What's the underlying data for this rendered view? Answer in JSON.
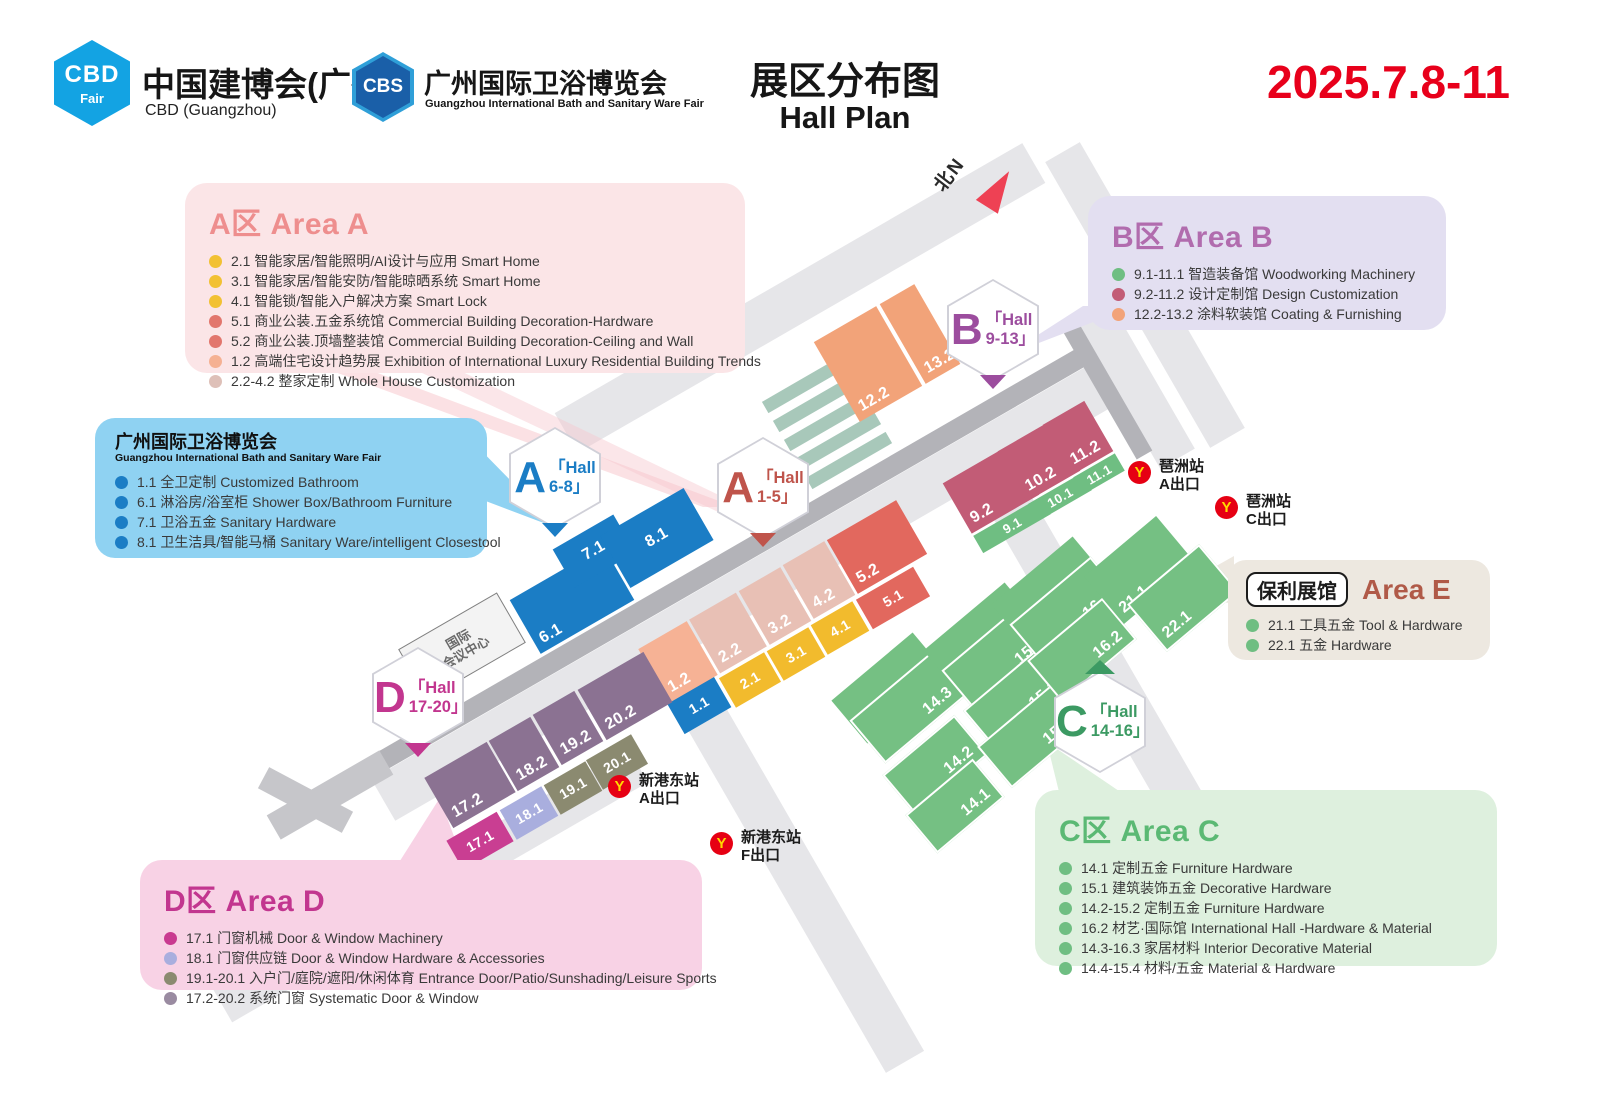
{
  "header": {
    "logo_cbd": {
      "icon": "CBD",
      "icon_sub": "Fair",
      "title": "中国建博会(广州)",
      "subtitle": "CBD (Guangzhou)"
    },
    "logo_cbs": {
      "icon": "CBS",
      "title": "广州国际卫浴博览会",
      "subtitle": "Guangzhou International Bath and Sanitary Ware Fair"
    },
    "title_cn": "展区分布图",
    "title_en": "Hall Plan",
    "date": "2025.7.8-11",
    "date_color": "#e8001b"
  },
  "north_label": "北N",
  "legends": {
    "area_a": {
      "title": "A区 Area A",
      "accent": "#ee8e8e",
      "bg": "#fbe5e7",
      "items": [
        {
          "dot": "#f2c133",
          "text": "2.1 智能家居/智能照明/AI设计与应用 Smart Home"
        },
        {
          "dot": "#f2c133",
          "text": "3.1 智能家居/智能安防/智能晾晒系统 Smart Home"
        },
        {
          "dot": "#f2c133",
          "text": "4.1 智能锁/智能入户解决方案 Smart Lock"
        },
        {
          "dot": "#e2766d",
          "text": "5.1 商业公装.五金系统馆 Commercial Building Decoration-Hardware"
        },
        {
          "dot": "#e2766d",
          "text": "5.2 商业公装.顶墙整装馆 Commercial Building Decoration-Ceiling and Wall"
        },
        {
          "dot": "#f5b193",
          "text": "1.2 高端住宅设计趋势展 Exhibition of International Luxury Residential Building Trends"
        },
        {
          "dot": "#dec0b8",
          "text": "2.2-4.2 整家定制 Whole House Customization"
        }
      ]
    },
    "bath": {
      "title_cn": "广州国际卫浴博览会",
      "title_en": "Guangzhou International Bath and Sanitary Ware Fair",
      "bg": "#8fd2f2",
      "items": [
        {
          "dot": "#1b7dc5",
          "text": "1.1 全卫定制 Customized Bathroom"
        },
        {
          "dot": "#1b7dc5",
          "text": "6.1 淋浴房/浴室柜 Shower Box/Bathroom Furniture"
        },
        {
          "dot": "#1b7dc5",
          "text": "7.1 卫浴五金 Sanitary Hardware"
        },
        {
          "dot": "#1b7dc5",
          "text": "8.1 卫生洁具/智能马桶 Sanitary Ware/intelligent Closestool"
        }
      ]
    },
    "area_b": {
      "title": "B区 Area B",
      "accent": "#b16cae",
      "bg": "#e3dff1",
      "items": [
        {
          "dot": "#6fbe82",
          "text": "9.1-11.1 智造装备馆 Woodworking Machinery"
        },
        {
          "dot": "#c25c76",
          "text": "9.2-11.2 设计定制馆 Design Customization"
        },
        {
          "dot": "#f2a379",
          "text": "12.2-13.2 涂料软装馆 Coating & Furnishing"
        }
      ]
    },
    "area_e": {
      "venue": "保利展馆",
      "title": "Area E",
      "accent": "#b05a48",
      "bg": "#ede8e0",
      "items": [
        {
          "dot": "#6fbe82",
          "text": "21.1 工具五金 Tool & Hardware"
        },
        {
          "dot": "#6fbe82",
          "text": "22.1 五金 Hardware"
        }
      ]
    },
    "area_c": {
      "title": "C区 Area C",
      "accent": "#5bb974",
      "bg": "#def0de",
      "items": [
        {
          "dot": "#6fbe82",
          "text": "14.1 定制五金 Furniture Hardware"
        },
        {
          "dot": "#6fbe82",
          "text": "15.1 建筑装饰五金 Decorative Hardware"
        },
        {
          "dot": "#6fbe82",
          "text": "14.2-15.2 定制五金 Furniture Hardware"
        },
        {
          "dot": "#6fbe82",
          "text": "16.2 材艺·国际馆 International Hall -Hardware & Material"
        },
        {
          "dot": "#6fbe82",
          "text": "14.3-16.3 家居材料 Interior Decorative Material"
        },
        {
          "dot": "#6fbe82",
          "text": "14.4-15.4 材料/五金 Material & Hardware"
        }
      ]
    },
    "area_d": {
      "title": "D区 Area D",
      "accent": "#c2368f",
      "bg": "#f8d2e5",
      "items": [
        {
          "dot": "#c93a90",
          "text": "17.1 门窗机械 Door & Window Machinery"
        },
        {
          "dot": "#a9aede",
          "text": "18.1 门窗供应链 Door & Window Hardware & Accessories"
        },
        {
          "dot": "#8b8a70",
          "text": "19.1-20.1 入户门/庭院/遮阳/休闲体育 Entrance Door/Patio/Sunshading/Leisure Sports"
        },
        {
          "dot": "#9a8ba1",
          "text": "17.2-20.2 系统门窗 Systematic Door & Window"
        }
      ]
    }
  },
  "map": {
    "convention_center": {
      "line1": "国际",
      "line2": "会议中心"
    },
    "metro_colors": {
      "circle": "#e60013",
      "glyph": "#ffd800"
    },
    "badges": [
      {
        "id": "a-6-8",
        "letter": "A",
        "hall": "「Hall",
        "range": "6-8」",
        "color": "#1b7dc5",
        "x": 555,
        "y": 478,
        "ptr": "down"
      },
      {
        "id": "a-1-5",
        "letter": "A",
        "hall": "「Hall",
        "range": "1-5」",
        "color": "#bf544b",
        "x": 763,
        "y": 488,
        "ptr": "down"
      },
      {
        "id": "b-9-13",
        "letter": "B",
        "hall": "「Hall",
        "range": "9-13」",
        "color": "#9c4d9e",
        "x": 993,
        "y": 330,
        "ptr": "down"
      },
      {
        "id": "c-14-16",
        "letter": "C",
        "hall": "「Hall",
        "range": "14-16」",
        "color": "#3c9a63",
        "x": 1100,
        "y": 722,
        "ptr": "up"
      },
      {
        "id": "d-17-20",
        "letter": "D",
        "hall": "「Hall",
        "range": "17-20」",
        "color": "#c2368f",
        "x": 418,
        "y": 698,
        "ptr": "down"
      }
    ],
    "stations": [
      {
        "name": "琶洲站",
        "exit": "A出口",
        "x": 1140,
        "y": 472
      },
      {
        "name": "琶洲站",
        "exit": "C出口",
        "x": 1227,
        "y": 507
      },
      {
        "name": "新港东站",
        "exit": "A出口",
        "x": 620,
        "y": 786
      },
      {
        "name": "新港东站",
        "exit": "F出口",
        "x": 722,
        "y": 843
      }
    ],
    "blocks": [
      {
        "label": "6.1",
        "x": 572,
        "y": 600,
        "w": 108,
        "h": 62,
        "r": -30,
        "c": "#1b7dc5",
        "lp": "bl"
      },
      {
        "label": "7.1",
        "x": 594,
        "y": 551,
        "w": 70,
        "h": 44,
        "r": -30,
        "c": "#1b7dc5",
        "lp": "c"
      },
      {
        "label": "8.1",
        "x": 657,
        "y": 538,
        "w": 96,
        "h": 60,
        "r": -30,
        "c": "#1b7dc5",
        "lp": "c"
      },
      {
        "label": "1.1",
        "x": 699,
        "y": 705,
        "w": 54,
        "h": 36,
        "r": -30,
        "c": "#1b7dc5",
        "lp": "c"
      },
      {
        "label": "1.2",
        "x": 678,
        "y": 662,
        "w": 56,
        "h": 62,
        "r": -30,
        "c": "#f6b295",
        "lp": "bl"
      },
      {
        "label": "2.2",
        "x": 728,
        "y": 633,
        "w": 54,
        "h": 62,
        "r": -30,
        "c": "#e8c0b5",
        "lp": "bl"
      },
      {
        "label": "3.2",
        "x": 775,
        "y": 606,
        "w": 48,
        "h": 62,
        "r": -30,
        "c": "#e8c0b5",
        "lp": "bl"
      },
      {
        "label": "4.2",
        "x": 819,
        "y": 580,
        "w": 48,
        "h": 62,
        "r": -30,
        "c": "#e8c0b5",
        "lp": "bl"
      },
      {
        "label": "5.2",
        "x": 877,
        "y": 547,
        "w": 80,
        "h": 62,
        "r": -30,
        "c": "#e2685e",
        "lp": "bl"
      },
      {
        "label": "2.1",
        "x": 750,
        "y": 680,
        "w": 52,
        "h": 34,
        "r": -30,
        "c": "#f2bb2d",
        "lp": "c"
      },
      {
        "label": "3.1",
        "x": 796,
        "y": 654,
        "w": 48,
        "h": 34,
        "r": -30,
        "c": "#f2bb2d",
        "lp": "c"
      },
      {
        "label": "4.1",
        "x": 840,
        "y": 628,
        "w": 48,
        "h": 34,
        "r": -30,
        "c": "#f2bb2d",
        "lp": "c"
      },
      {
        "label": "5.1",
        "x": 893,
        "y": 598,
        "w": 66,
        "h": 34,
        "r": -30,
        "c": "#e2685e",
        "lp": "c"
      },
      {
        "label": "12.2",
        "x": 868,
        "y": 364,
        "w": 72,
        "h": 92,
        "r": -30,
        "c": "#f2a379",
        "lp": "bl"
      },
      {
        "label": "13.2",
        "x": 920,
        "y": 334,
        "w": 40,
        "h": 92,
        "r": -30,
        "c": "#f2a379",
        "lp": "bl"
      },
      {
        "label": "9.2",
        "x": 991,
        "y": 489,
        "w": 78,
        "h": 58,
        "r": -30,
        "c": "#c25c76",
        "lp": "bl"
      },
      {
        "label": "10.2",
        "x": 1039,
        "y": 461,
        "w": 62,
        "h": 58,
        "r": -30,
        "c": "#c25c76",
        "lp": "bl"
      },
      {
        "label": "11.2",
        "x": 1078,
        "y": 438,
        "w": 48,
        "h": 58,
        "r": -30,
        "c": "#c25c76",
        "lp": "bl"
      },
      {
        "label": "9.1",
        "x": 1012,
        "y": 525,
        "w": 78,
        "h": 20,
        "r": -30,
        "c": "#6fbe82",
        "lp": "c"
      },
      {
        "label": "10.1",
        "x": 1060,
        "y": 497,
        "w": 62,
        "h": 20,
        "r": -30,
        "c": "#6fbe82",
        "lp": "c"
      },
      {
        "label": "11.1",
        "x": 1099,
        "y": 474,
        "w": 48,
        "h": 20,
        "r": -30,
        "c": "#6fbe82",
        "lp": "c"
      },
      {
        "label": "17.2",
        "x": 470,
        "y": 785,
        "w": 72,
        "h": 58,
        "r": -30,
        "c": "#8b7292",
        "lp": "bl"
      },
      {
        "label": "18.2",
        "x": 524,
        "y": 754,
        "w": 48,
        "h": 58,
        "r": -30,
        "c": "#8b7292",
        "lp": "bl"
      },
      {
        "label": "19.2",
        "x": 568,
        "y": 728,
        "w": 48,
        "h": 58,
        "r": -30,
        "c": "#8b7292",
        "lp": "bl"
      },
      {
        "label": "20.2",
        "x": 625,
        "y": 696,
        "w": 76,
        "h": 58,
        "r": -30,
        "c": "#8b7292",
        "lp": "bl"
      },
      {
        "label": "17.1",
        "x": 480,
        "y": 841,
        "w": 58,
        "h": 34,
        "r": -30,
        "c": "#c93e92",
        "lp": "c"
      },
      {
        "label": "18.1",
        "x": 529,
        "y": 813,
        "w": 48,
        "h": 34,
        "r": -30,
        "c": "#a9aede",
        "lp": "c"
      },
      {
        "label": "19.1",
        "x": 573,
        "y": 788,
        "w": 48,
        "h": 34,
        "r": -30,
        "c": "#8b8a70",
        "lp": "c"
      },
      {
        "label": "20.1",
        "x": 617,
        "y": 762,
        "w": 52,
        "h": 34,
        "r": -30,
        "c": "#8b8a70",
        "lp": "c"
      },
      {
        "label": "14.4",
        "x": 890,
        "y": 688,
        "w": 106,
        "h": 56,
        "r": -40,
        "c": "#75c083",
        "lp": "br"
      },
      {
        "label": "14.3",
        "x": 908,
        "y": 708,
        "w": 106,
        "h": 56,
        "r": -40,
        "c": "#75c083",
        "lp": "br",
        "bd": true
      },
      {
        "label": "14.2",
        "x": 935,
        "y": 765,
        "w": 94,
        "h": 52,
        "r": -40,
        "c": "#75c083",
        "lp": "br",
        "bd": true
      },
      {
        "label": "14.1",
        "x": 955,
        "y": 806,
        "w": 88,
        "h": 50,
        "r": -40,
        "c": "#75c083",
        "lp": "br",
        "bd": true
      },
      {
        "label": "15.4",
        "x": 982,
        "y": 638,
        "w": 106,
        "h": 56,
        "r": -40,
        "c": "#75c083",
        "lp": "br"
      },
      {
        "label": "15.3",
        "x": 1000,
        "y": 658,
        "w": 106,
        "h": 56,
        "r": -40,
        "c": "#75c083",
        "lp": "br",
        "bd": true
      },
      {
        "label": "15.2",
        "x": 1018,
        "y": 700,
        "w": 98,
        "h": 54,
        "r": -40,
        "c": "#75c083",
        "lp": "br",
        "bd": true
      },
      {
        "label": "15.1",
        "x": 1032,
        "y": 736,
        "w": 98,
        "h": 54,
        "r": -40,
        "c": "#75c083",
        "lp": "br",
        "bd": true
      },
      {
        "label": "16.4",
        "x": 1050,
        "y": 592,
        "w": 106,
        "h": 56,
        "r": -40,
        "c": "#75c083",
        "lp": "br"
      },
      {
        "label": "16.3",
        "x": 1068,
        "y": 612,
        "w": 106,
        "h": 56,
        "r": -40,
        "c": "#75c083",
        "lp": "br",
        "bd": true
      },
      {
        "label": "16.2",
        "x": 1082,
        "y": 650,
        "w": 98,
        "h": 54,
        "r": -40,
        "c": "#75c083",
        "lp": "br",
        "bd": true
      },
      {
        "label": "21.1",
        "x": 1140,
        "y": 570,
        "w": 94,
        "h": 62,
        "r": -40,
        "c": "#75c083",
        "lp": "bl"
      },
      {
        "label": "22.1",
        "x": 1183,
        "y": 598,
        "w": 94,
        "h": 62,
        "r": -40,
        "c": "#75c083",
        "lp": "bl",
        "bd": true
      }
    ]
  }
}
